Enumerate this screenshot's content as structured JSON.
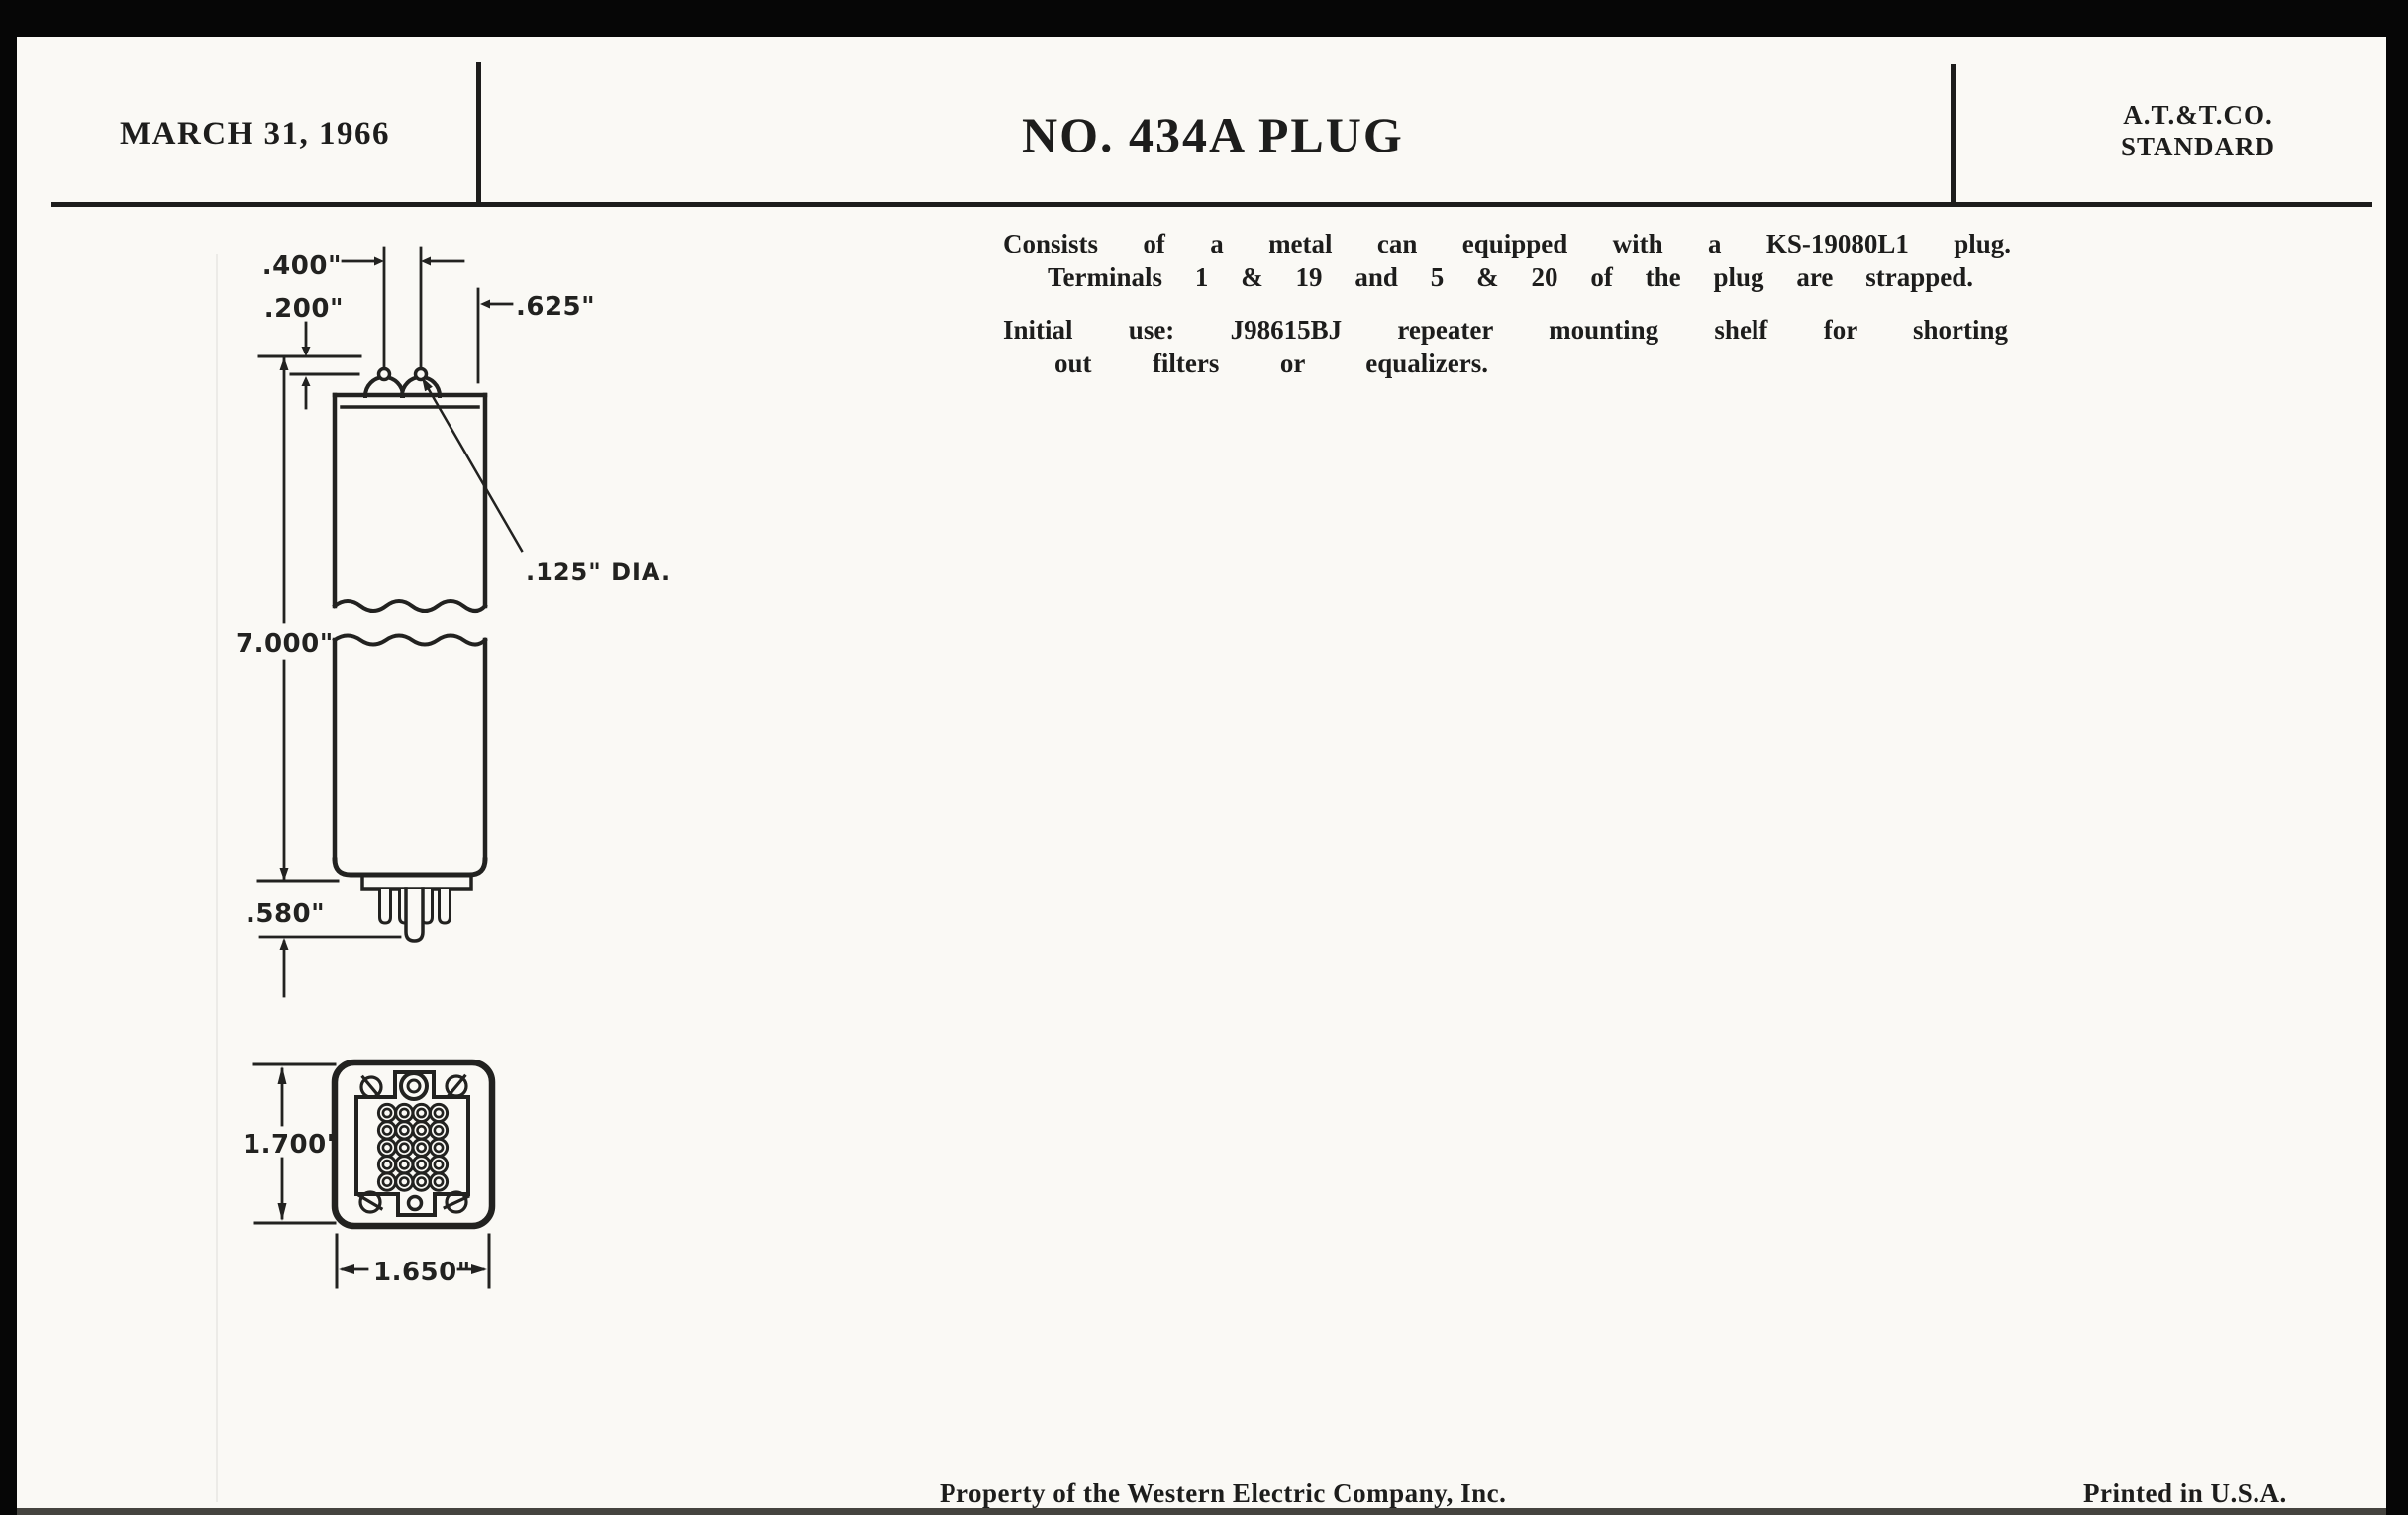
{
  "header": {
    "date": "MARCH 31, 1966",
    "title": "NO. 434A PLUG",
    "org_line1": "A.T.&T.CO.",
    "org_line2": "STANDARD"
  },
  "body": {
    "line1": "Consists of a metal can equipped with a KS-19080L1 plug.",
    "line2": "Terminals 1 & 19 and 5 & 20 of the plug are strapped.",
    "line3": "Initial use: J98615BJ repeater mounting shelf for shorting",
    "line4": "out filters or equalizers."
  },
  "drawing": {
    "dim_hole_spacing": ".400\"",
    "dim_ear_height": ".200\"",
    "dim_edge_offset": ".625\"",
    "dim_hole_dia": ".125\" DIA.",
    "dim_can_length": "7.000\"",
    "dim_pin_length": ".580\"",
    "dim_face_height": "1.700\"",
    "dim_face_width": "1.650\""
  },
  "footer": {
    "property": "Property of the Western Electric Company, Inc.",
    "printed": "Printed in U.S.A."
  },
  "colors": {
    "ink": "#1d1d1c",
    "paper": "#faf9f5",
    "scan_edge": "#060606"
  }
}
